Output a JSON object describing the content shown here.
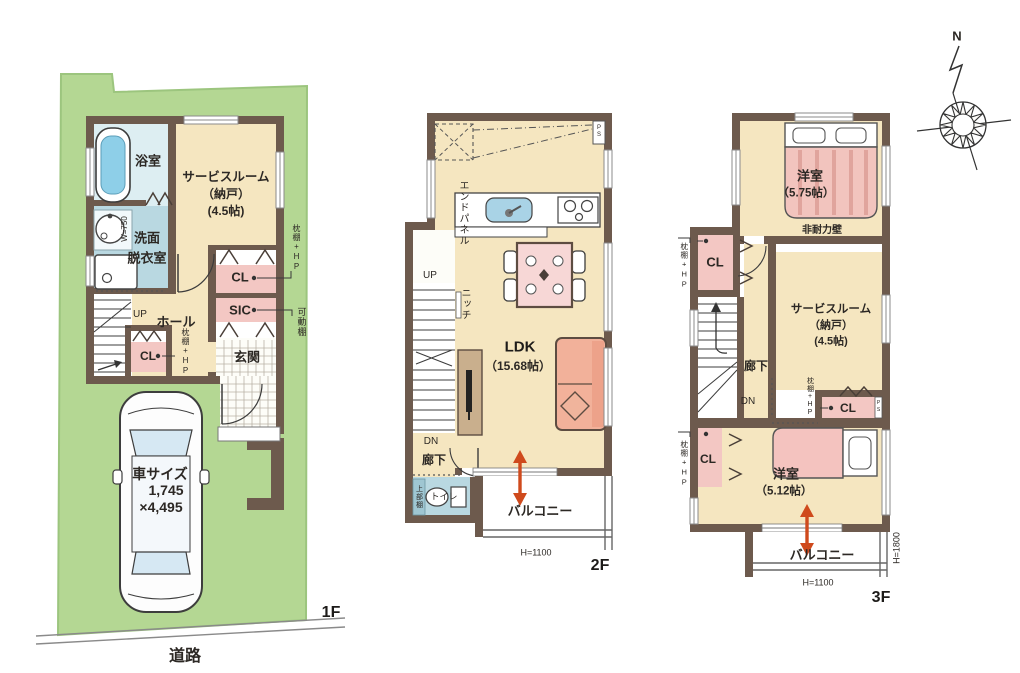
{
  "colors": {
    "lot_green": "#b4d793",
    "wall_brown": "#6d5a4d",
    "room_beige": "#f5e6c0",
    "wet_blue": "#b9d8e1",
    "closet_pink": "#f3c7c3",
    "accent_orange": "#cf4a1d"
  },
  "compass": {
    "north_label": "N"
  },
  "f1": {
    "floor_label": "1F",
    "road_label": "道路",
    "bath": "浴室",
    "service_room_l1": "サービスルーム",
    "service_room_l2": "（納戸）",
    "service_room_l3": "(4.5帖)",
    "washroom_l1": "洗面",
    "washroom_l2": "脱衣室",
    "basin_width": "W=750",
    "closet_main": "CL",
    "shoe_closet": "SIC",
    "entrance": "玄関",
    "hall": "ホール",
    "up": "UP",
    "closet_hall": "CL",
    "shelf_note_right": "枕棚+HP",
    "shelf_note_hall": "枕棚+HP",
    "movable_shelf_note": "可動棚",
    "car_l1": "車サイズ",
    "car_l2": "1,745",
    "car_l3": "×4,495"
  },
  "f2": {
    "floor_label": "2F",
    "pipe_space": "PS",
    "end_panel": "エンドパネル",
    "up": "UP",
    "niche": "ニッチ",
    "ldk": "LDK",
    "ldk_size": "（15.68帖）",
    "down": "DN",
    "corridor": "廊下",
    "upper_shelf": "上部棚",
    "toilet": "トイレ",
    "balcony": "バルコニー",
    "balcony_height": "H=1100"
  },
  "f3": {
    "floor_label": "3F",
    "bedroom_main": "洋室",
    "bedroom_main_size": "（5.75帖）",
    "non_bearing_wall": "非耐力壁",
    "closet_top": "CL",
    "shelf_note_top": "枕棚+HP",
    "corridor": "廊下",
    "down": "DN",
    "service_room_l1": "サービスルーム",
    "service_room_l2": "（納戸）",
    "service_room_l3": "(4.5帖)",
    "closet_mid": "CL",
    "shelf_note_mid": "枕棚+HP",
    "pipe_space": "PS",
    "bedroom_second": "洋室",
    "bedroom_second_size": "（5.12帖）",
    "closet_bottom": "CL",
    "shelf_note_bottom": "枕棚+HP",
    "balcony": "バルコニー",
    "balcony_height": "H=1100",
    "window_height": "H=1800"
  }
}
